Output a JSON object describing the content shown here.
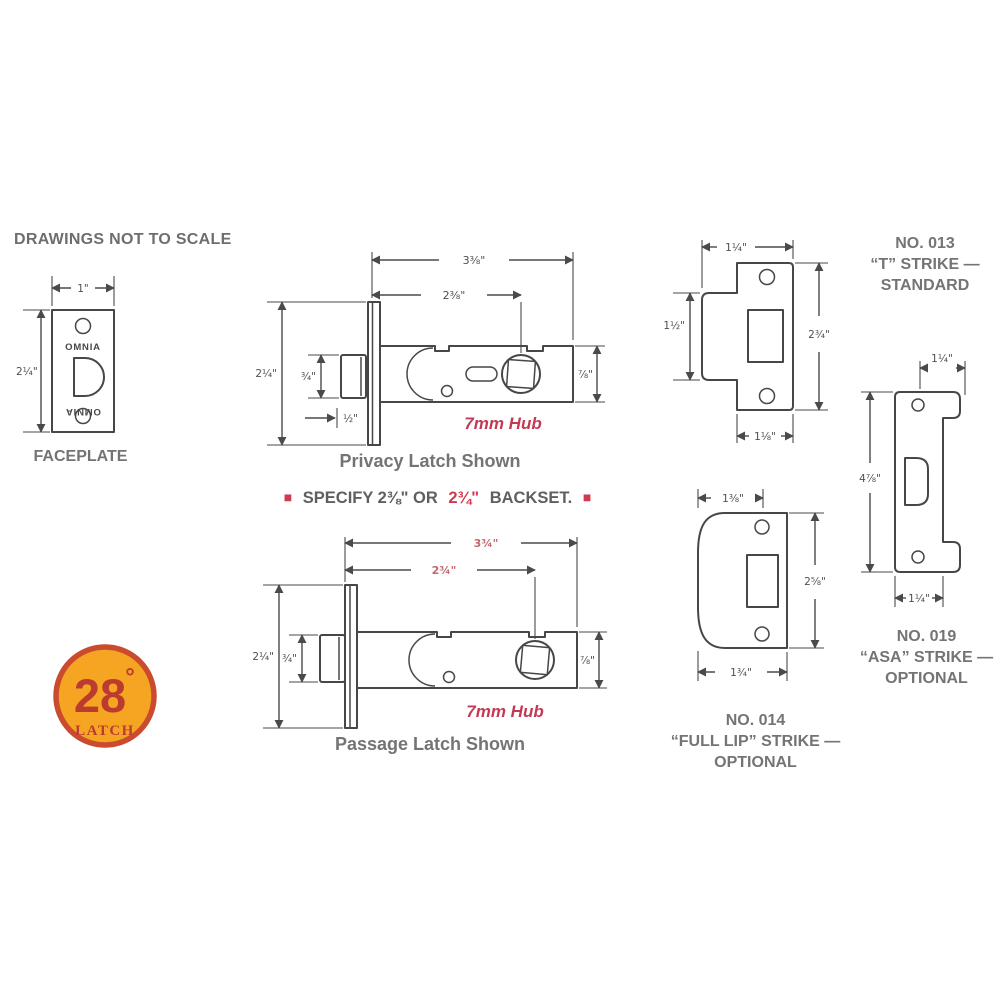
{
  "title": "DRAWINGS NOT TO SCALE",
  "faceplate": {
    "caption": "FACEPLATE",
    "brand": "OMNIA",
    "dims": {
      "width": "1\"",
      "height": "2¼\""
    }
  },
  "privacy_latch": {
    "caption": "Privacy Latch Shown",
    "hub": "7mm Hub",
    "dims": {
      "overall": "3⅜\"",
      "backset": "2⅜\"",
      "height": "2¼\"",
      "bolt": "¾\"",
      "projection": "½\"",
      "case": "⅞\""
    }
  },
  "backset_note": {
    "bullet": "■",
    "pre": "SPECIFY 2⅜\" OR",
    "highlight": "2¾\"",
    "post": "BACKSET."
  },
  "passage_latch": {
    "caption": "Passage Latch Shown",
    "hub": "7mm Hub",
    "dims": {
      "overall": "3¾\"",
      "backset": "2¾\"",
      "height": "2¼\"",
      "bolt": "¾\"",
      "case": "⅞\""
    }
  },
  "logo": {
    "number": "28",
    "degree": "°",
    "word": "LATCH"
  },
  "t_strike": {
    "lines": [
      "NO. 013",
      "“T” STRIKE —",
      "STANDARD"
    ],
    "dims": {
      "top": "1¼\"",
      "left": "1½\"",
      "right": "2¾\"",
      "bottom": "1⅛\""
    }
  },
  "full_lip_strike": {
    "lines": [
      "NO. 014",
      "“FULL LIP”  STRIKE —",
      "OPTIONAL"
    ],
    "dims": {
      "top": "1⅜\"",
      "right": "2⅝\"",
      "bottom": "1¾\""
    }
  },
  "asa_strike": {
    "lines": [
      "NO. 019",
      "“ASA” STRIKE —",
      "OPTIONAL"
    ],
    "dims": {
      "top": "1¼\"",
      "height": "4⅞\"",
      "bottom": "1¼\""
    }
  },
  "colors": {
    "line": "#474747",
    "caption_gray": "#747474",
    "red": "#C43A54",
    "dim_red": "#C4656D",
    "note_red": "#CF3A50",
    "logo_orange": "#F5A522",
    "logo_ring": "#CB4B2E",
    "logo_red": "#BC3B31"
  }
}
